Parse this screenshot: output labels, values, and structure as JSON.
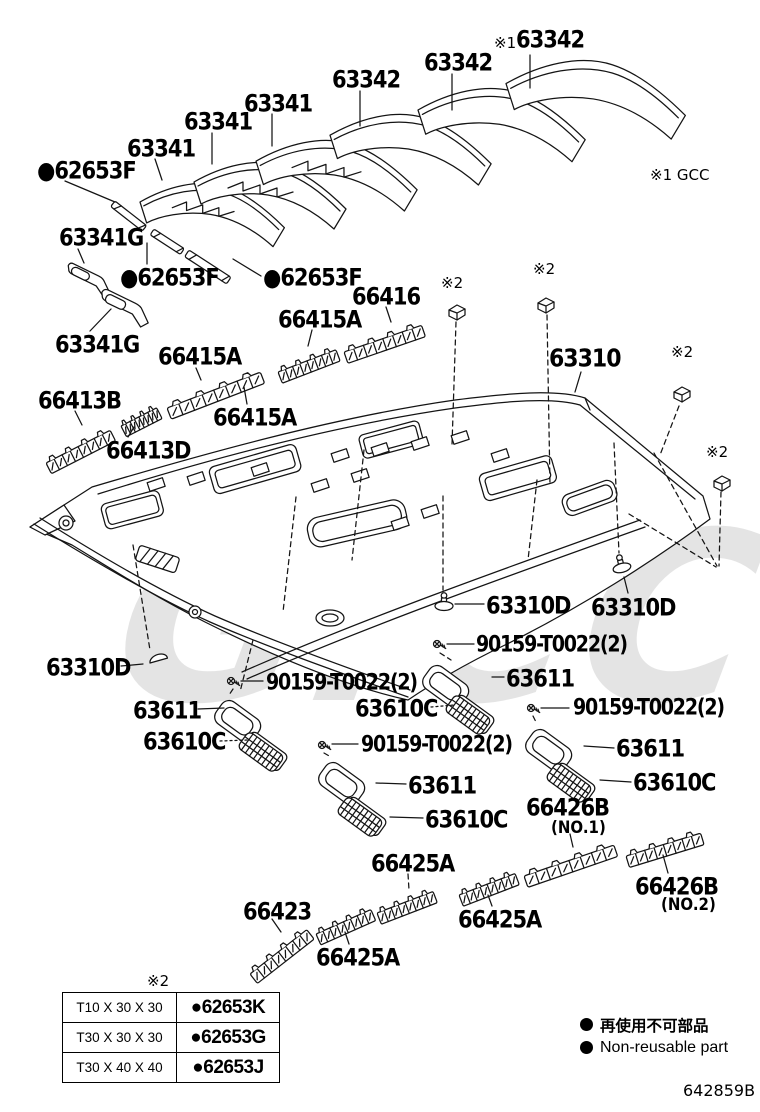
{
  "watermark": {
    "text": "GiCC"
  },
  "labels": [
    {
      "t": "※1"
    },
    {
      "t": "63342"
    },
    {
      "t": "63342"
    },
    {
      "t": "63342"
    },
    {
      "t": "63341"
    },
    {
      "t": "63341"
    },
    {
      "t": "63341"
    },
    {
      "t": "●62653F"
    },
    {
      "t": "63341G"
    },
    {
      "t": "●62653F"
    },
    {
      "t": "●62653F"
    },
    {
      "t": "※1 GCC"
    },
    {
      "t": "63341G"
    },
    {
      "t": "66416"
    },
    {
      "t": "66415A"
    },
    {
      "t": "※2"
    },
    {
      "t": "※2"
    },
    {
      "t": "63310"
    },
    {
      "t": "※2"
    },
    {
      "t": "66415A"
    },
    {
      "t": "66413B"
    },
    {
      "t": "66415A"
    },
    {
      "t": "66413D"
    },
    {
      "t": "※2"
    },
    {
      "t": "63310D"
    },
    {
      "t": "63310D"
    },
    {
      "t": "90159-T0022(2)"
    },
    {
      "t": "63611"
    },
    {
      "t": "63310D"
    },
    {
      "t": "90159-T0022(2)"
    },
    {
      "t": "63611"
    },
    {
      "t": "90159-T0022(2)"
    },
    {
      "t": "63610C"
    },
    {
      "t": "63610C"
    },
    {
      "t": "90159-T0022(2)"
    },
    {
      "t": "63611"
    },
    {
      "t": "63610C"
    },
    {
      "t": "63611"
    },
    {
      "t": "66426B"
    },
    {
      "t": "(NO.1)"
    },
    {
      "t": "63610C"
    },
    {
      "t": "66425A"
    },
    {
      "t": "66426B"
    },
    {
      "t": "(NO.2)"
    },
    {
      "t": "66423"
    },
    {
      "t": "66425A"
    },
    {
      "t": "66425A"
    },
    {
      "t": "※2"
    }
  ],
  "table": {
    "ref_note": "※2",
    "rows": [
      {
        "size": "T10 X 30 X 30",
        "part": "●62653K"
      },
      {
        "size": "T30 X 30 X 30",
        "part": "●62653G"
      },
      {
        "size": "T30 X 40 X 40",
        "part": "●62653J"
      }
    ]
  },
  "legend": {
    "jp": "再使用不可部品",
    "en": "Non-reusable part"
  },
  "doc_number": "642859B"
}
